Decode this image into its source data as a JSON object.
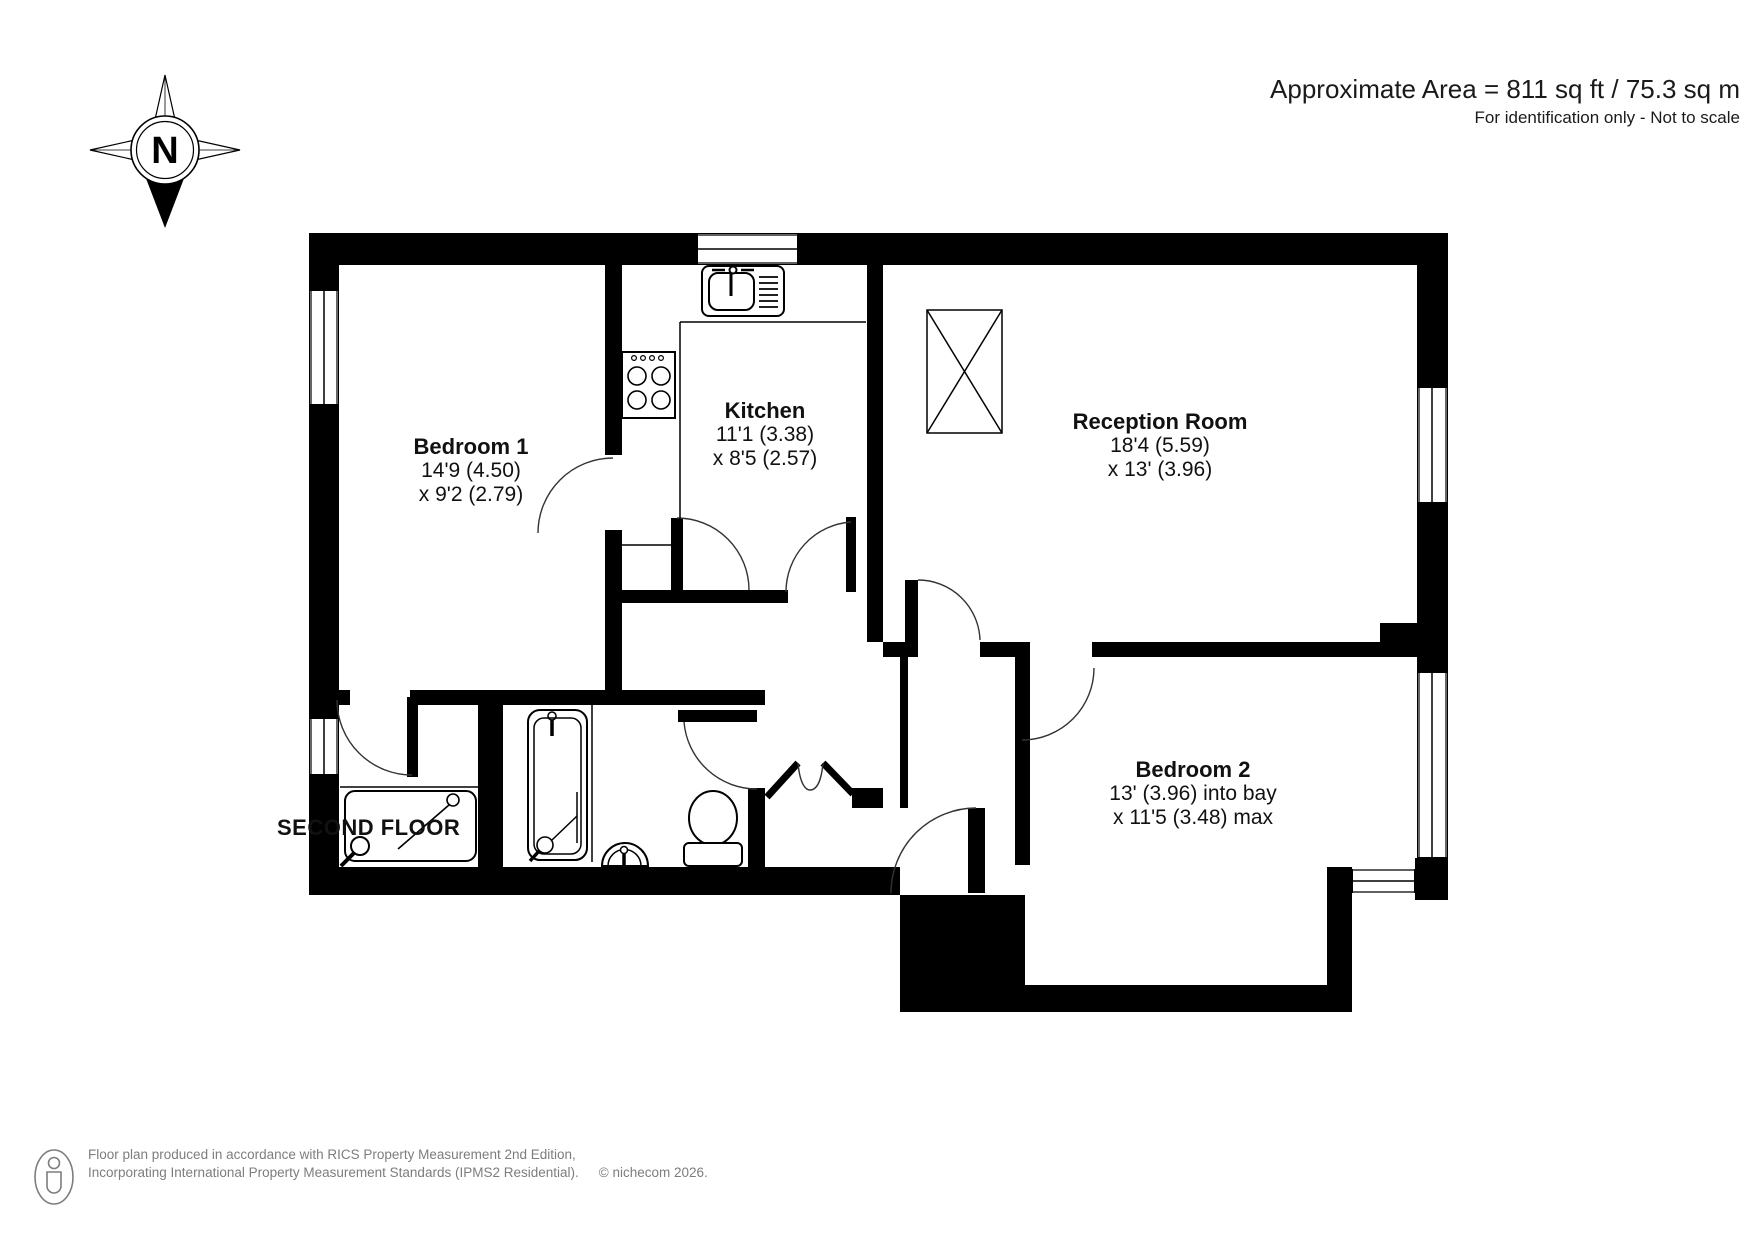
{
  "header": {
    "area": "Approximate Area = 811 sq ft / 75.3 sq m",
    "disclaimer": "For identification only - Not to scale"
  },
  "compass": {
    "north": "N"
  },
  "rooms": {
    "bedroom1": {
      "name": "Bedroom 1",
      "dim1": "14'9 (4.50)",
      "dim2": "x 9'2 (2.79)"
    },
    "kitchen": {
      "name": "Kitchen",
      "dim1": "11'1 (3.38)",
      "dim2": "x 8'5 (2.57)"
    },
    "reception": {
      "name": "Reception Room",
      "dim1": "18'4 (5.59)",
      "dim2": "x 13' (3.96)"
    },
    "bedroom2": {
      "name": "Bedroom 2",
      "dim1": "13' (3.96) into bay",
      "dim2": "x 11'5 (3.48) max"
    }
  },
  "floor_label": "SECOND FLOOR",
  "footer": {
    "line1": "Floor plan produced in accordance with RICS Property Measurement 2nd Edition,",
    "line2": "Incorporating International Property Measurement Standards (IPMS2 Residential).",
    "copyright": "© nichecom 2026."
  },
  "colors": {
    "walls": "#000000",
    "text": "#1a1a1a",
    "footer_text": "#7d7d7d"
  }
}
